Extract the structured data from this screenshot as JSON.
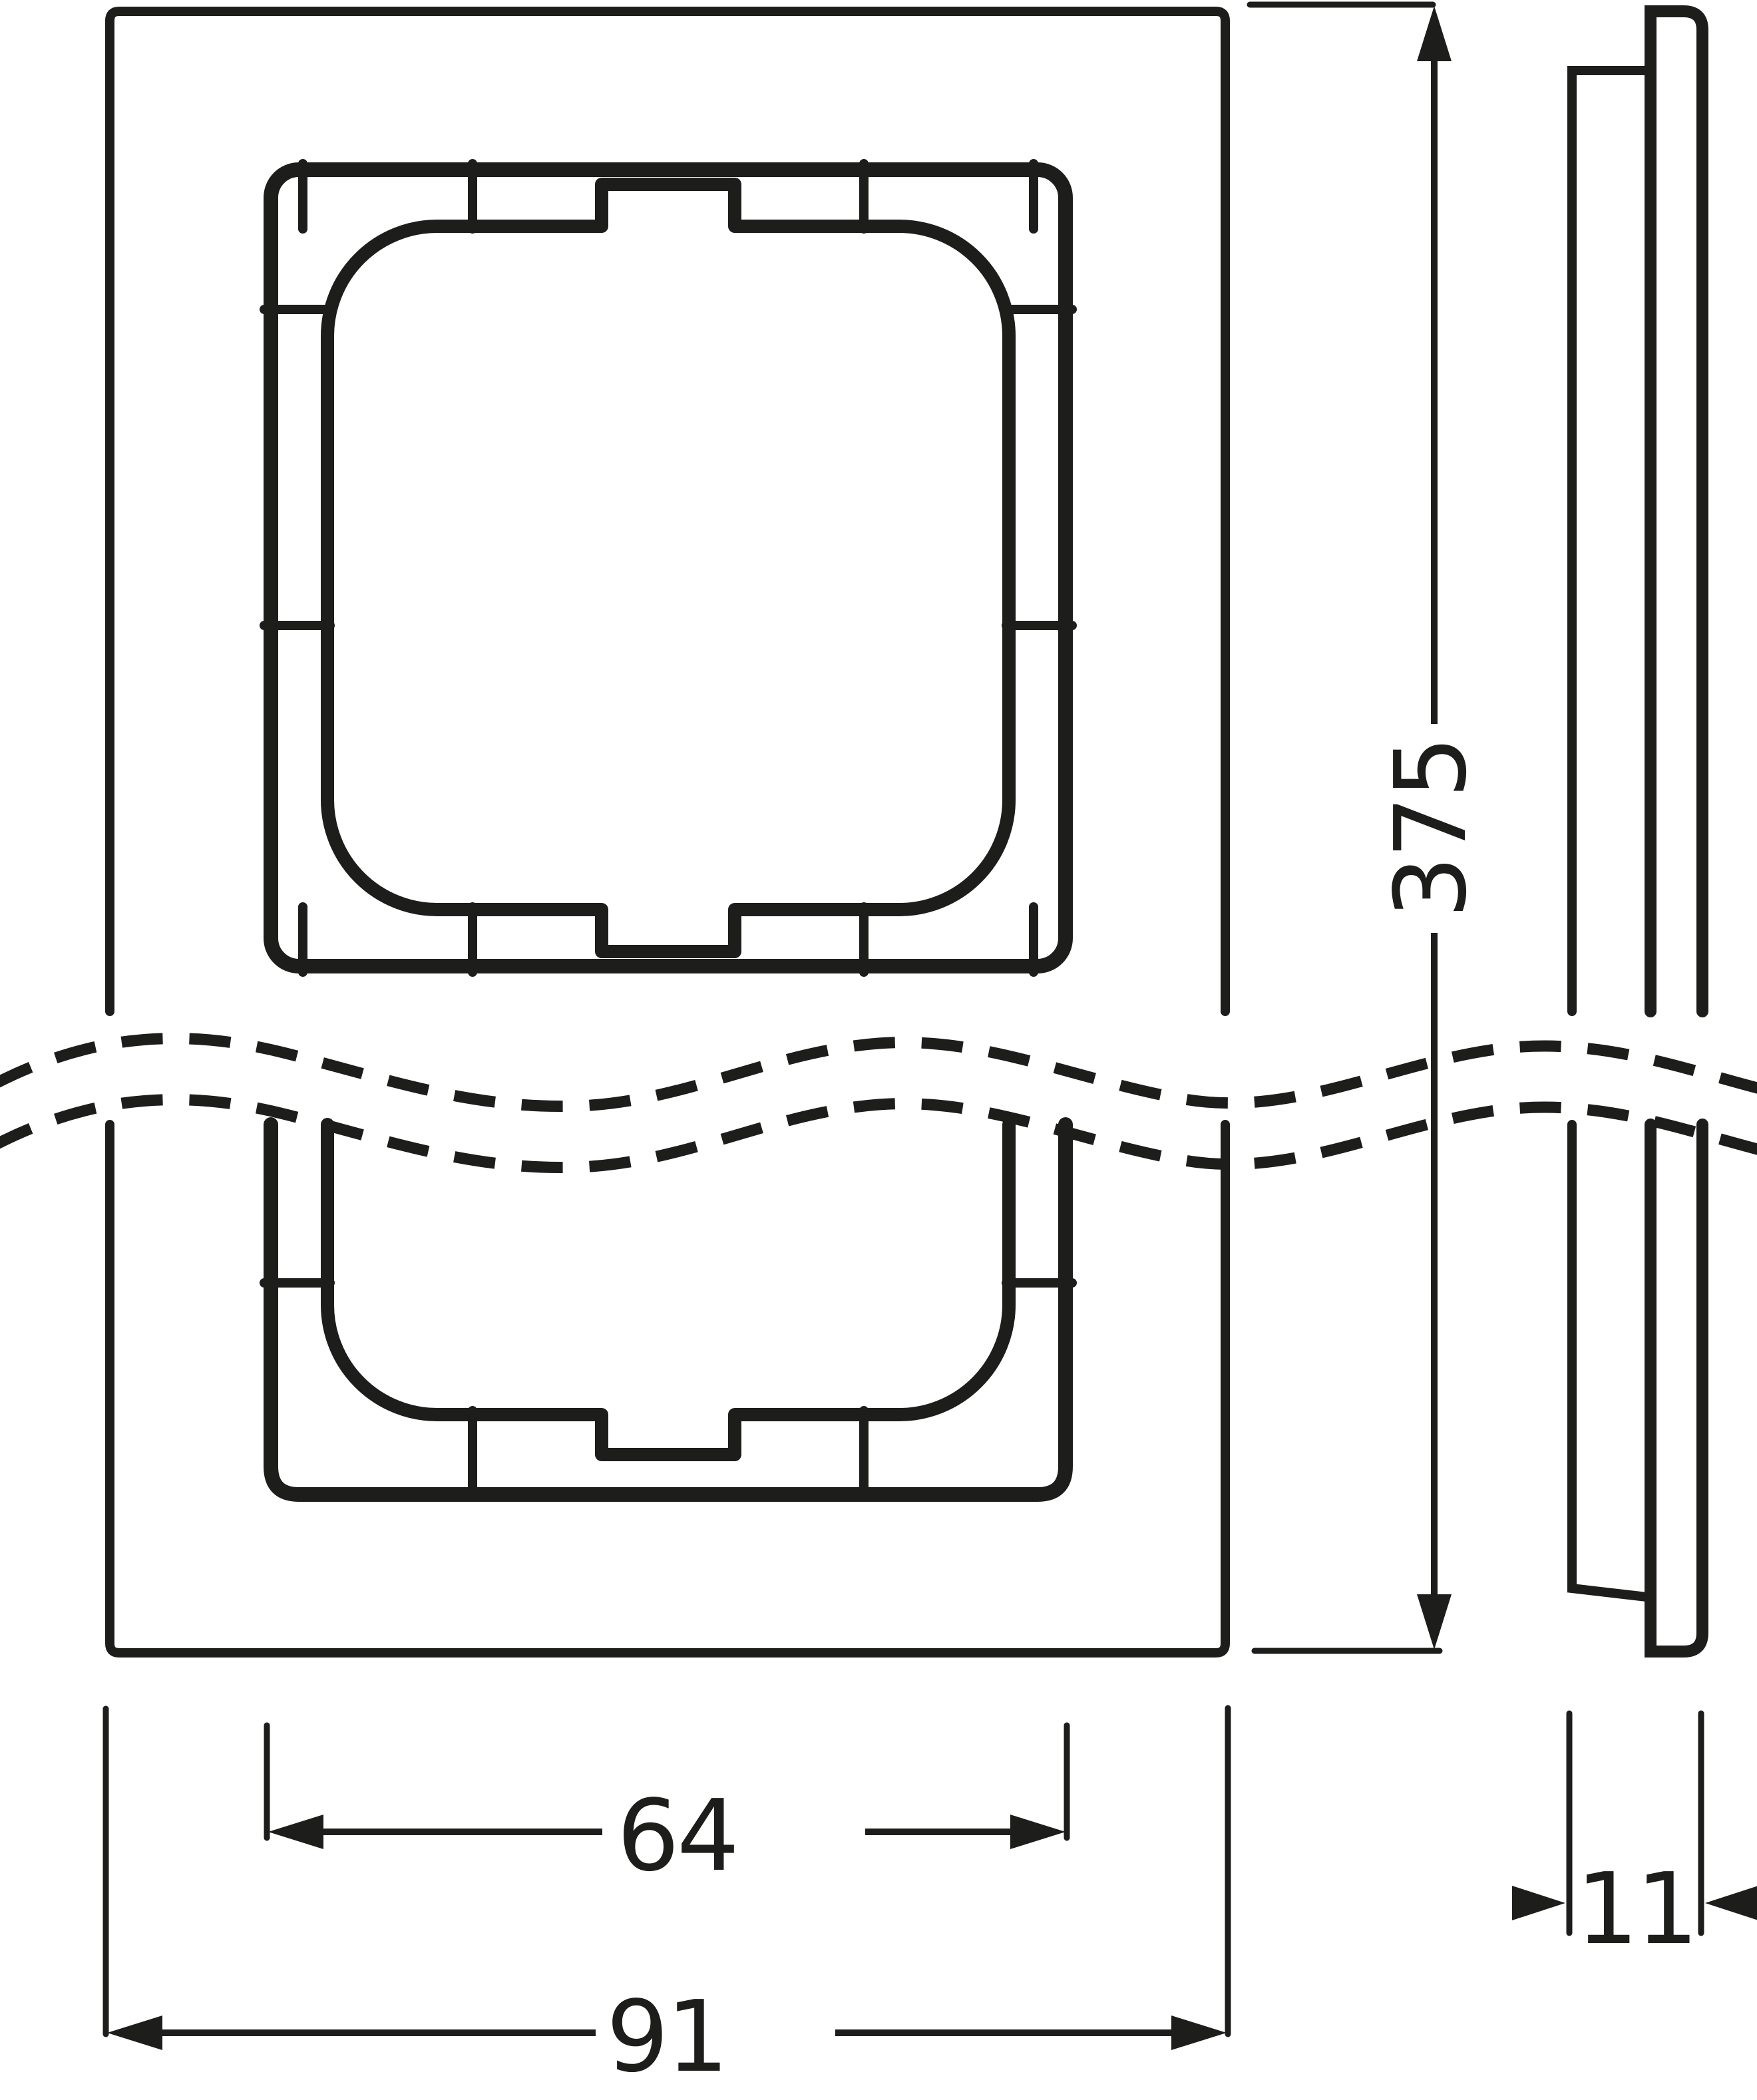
{
  "drawing": {
    "kind": "technical-dimension-drawing",
    "ink_color": "#1d1d1b",
    "paper_color": "#ffffff",
    "dimensions": {
      "height_label": "375",
      "cutout_width_label": "64",
      "frame_width_label": "91",
      "depth_label": "11"
    }
  }
}
